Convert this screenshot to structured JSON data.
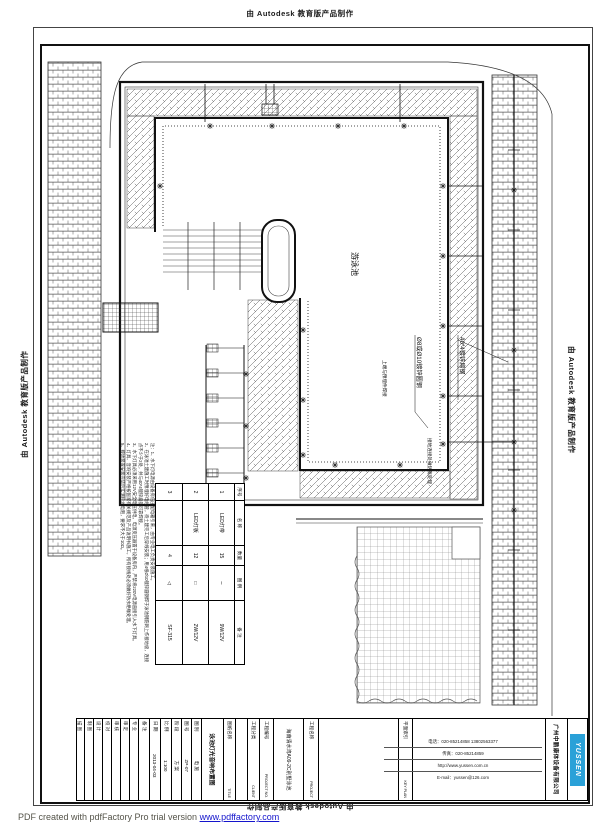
{
  "stamps": {
    "text": "由 Autodesk 教育版产品制作"
  },
  "watermark": {
    "prefix": "PDF created with pdfFactory Pro trial version ",
    "link": "www.pdffactory.com"
  },
  "drawing": {
    "pool_label": "游泳池",
    "annotations": {
      "a1": "Ø8或Ø10镀锌圆钢",
      "a2": "40*4镀锌扁钢",
      "a3": "上端与预埋件焊接",
      "a4": "接地连接处做防腐处理"
    },
    "stars": [
      [
        210,
        126
      ],
      [
        272,
        126
      ],
      [
        338,
        126
      ],
      [
        404,
        126
      ],
      [
        443,
        186
      ],
      [
        443,
        256
      ],
      [
        443,
        326
      ],
      [
        443,
        396
      ],
      [
        443,
        444
      ],
      [
        335,
        465
      ],
      [
        400,
        465
      ],
      [
        160,
        186
      ],
      [
        303,
        330
      ],
      [
        303,
        400
      ],
      [
        303,
        455
      ],
      [
        246,
        374
      ],
      [
        246,
        426
      ],
      [
        246,
        478
      ],
      [
        514,
        190
      ],
      [
        514,
        350
      ],
      [
        514,
        510
      ],
      [
        514,
        442
      ]
    ]
  },
  "notes": {
    "lines": [
      "注：1、水下灯电源由设备房低压配电箱引来，由专业电工负责安装施工。",
      "2、在泳池土建施工时预埋好电线管，待土建完工后穿线安装；用4根Ø10镀锌圆钢焊于泳池钢筋网上作接地极，连接点不少于2处，并与40*4镀锌扁钢可靠焊接。",
      "3、水下灯具必须采用12V安全电压供电，电源变压器置于设备房内，严禁将220V电源直接引入水下灯具。",
      "4、灯具、音响安装严格按国家有关规范及产品说明书施工，所有接线处必须做好防水绝缘处理。",
      "5、接地装置安装完毕后实测接地电阻，要求不大于10Ω。"
    ]
  },
  "fixture_table": {
    "headers": [
      "序号",
      "名 称",
      "数量",
      "图 例",
      "备 注"
    ],
    "rows": [
      [
        "1",
        "LED灯带",
        "15",
        "∼",
        "9W/12V"
      ],
      [
        "2",
        "LED灯板",
        "12",
        "□",
        "2W/12V"
      ],
      [
        "3",
        "",
        "4",
        "◁",
        "SF-315"
      ]
    ]
  },
  "titleblock": {
    "rows": [
      {
        "t": "logo",
        "h": 20,
        "text": "YUSSEN"
      },
      {
        "t": "center",
        "h": 22,
        "cls": "company",
        "text": "广州中鹏康体设备有限公司"
      },
      {
        "t": "empty",
        "h": 133
      },
      {
        "t": "pair",
        "h": 14,
        "zh": "平面索引",
        "en": "KEY PLAN"
      },
      {
        "t": "empty",
        "h": 80
      },
      {
        "t": "pair",
        "h": 15,
        "zh": "工程名称",
        "en": "PROJECT"
      },
      {
        "t": "center",
        "h": 30,
        "cls": "pname",
        "text": "海南清水湾A09-2C别墅泳池"
      },
      {
        "t": "pair",
        "h": 14,
        "zh": "工程编号",
        "en": "PROJECT NO."
      },
      {
        "t": "pair",
        "h": 12,
        "zh": "工程分类",
        "en": "CLIENT"
      },
      {
        "t": "empty",
        "h": 12
      },
      {
        "t": "pair",
        "h": 12,
        "zh": "图纸名称",
        "en": "TITLE"
      },
      {
        "t": "center",
        "h": 22,
        "cls": "dtitle",
        "text": "泳池灯光音响布置图"
      },
      {
        "t": "kv",
        "h": 10,
        "zh": "图 别",
        "v": "电 施"
      },
      {
        "t": "kv",
        "h": 10,
        "zh": "图 号",
        "v": "ZP-07"
      },
      {
        "t": "kv",
        "h": 10,
        "zh": "阶 段",
        "v": "方 案"
      },
      {
        "t": "kv",
        "h": 11,
        "zh": "比 例",
        "v": "1:100"
      },
      {
        "t": "kv",
        "h": 11,
        "zh": "日 期",
        "v": "2013-04-03"
      },
      {
        "t": "kv",
        "h": 11,
        "zh": "备 注",
        "v": ""
      },
      {
        "t": "sig",
        "h": 9,
        "zh": "专 业"
      },
      {
        "t": "sig",
        "h": 9,
        "zh": "审 定"
      },
      {
        "t": "sig",
        "h": 9,
        "zh": "审 核"
      },
      {
        "t": "sig",
        "h": 9,
        "zh": "校 对"
      },
      {
        "t": "sig",
        "h": 9,
        "zh": "设 计"
      },
      {
        "t": "sig",
        "h": 9,
        "zh": "制 图"
      },
      {
        "t": "sig",
        "h": 9,
        "zh": "描 图"
      }
    ]
  },
  "contact": {
    "lines": [
      "电话：020-85214858  13802563377",
      "传真：020-85214859",
      "http://www.yussen.com.cn",
      "E-mail：yussen@126.com"
    ]
  },
  "colors": {
    "logo_blue": "#2aa1d8",
    "link_blue": "#1414cc",
    "line": "#111111"
  }
}
